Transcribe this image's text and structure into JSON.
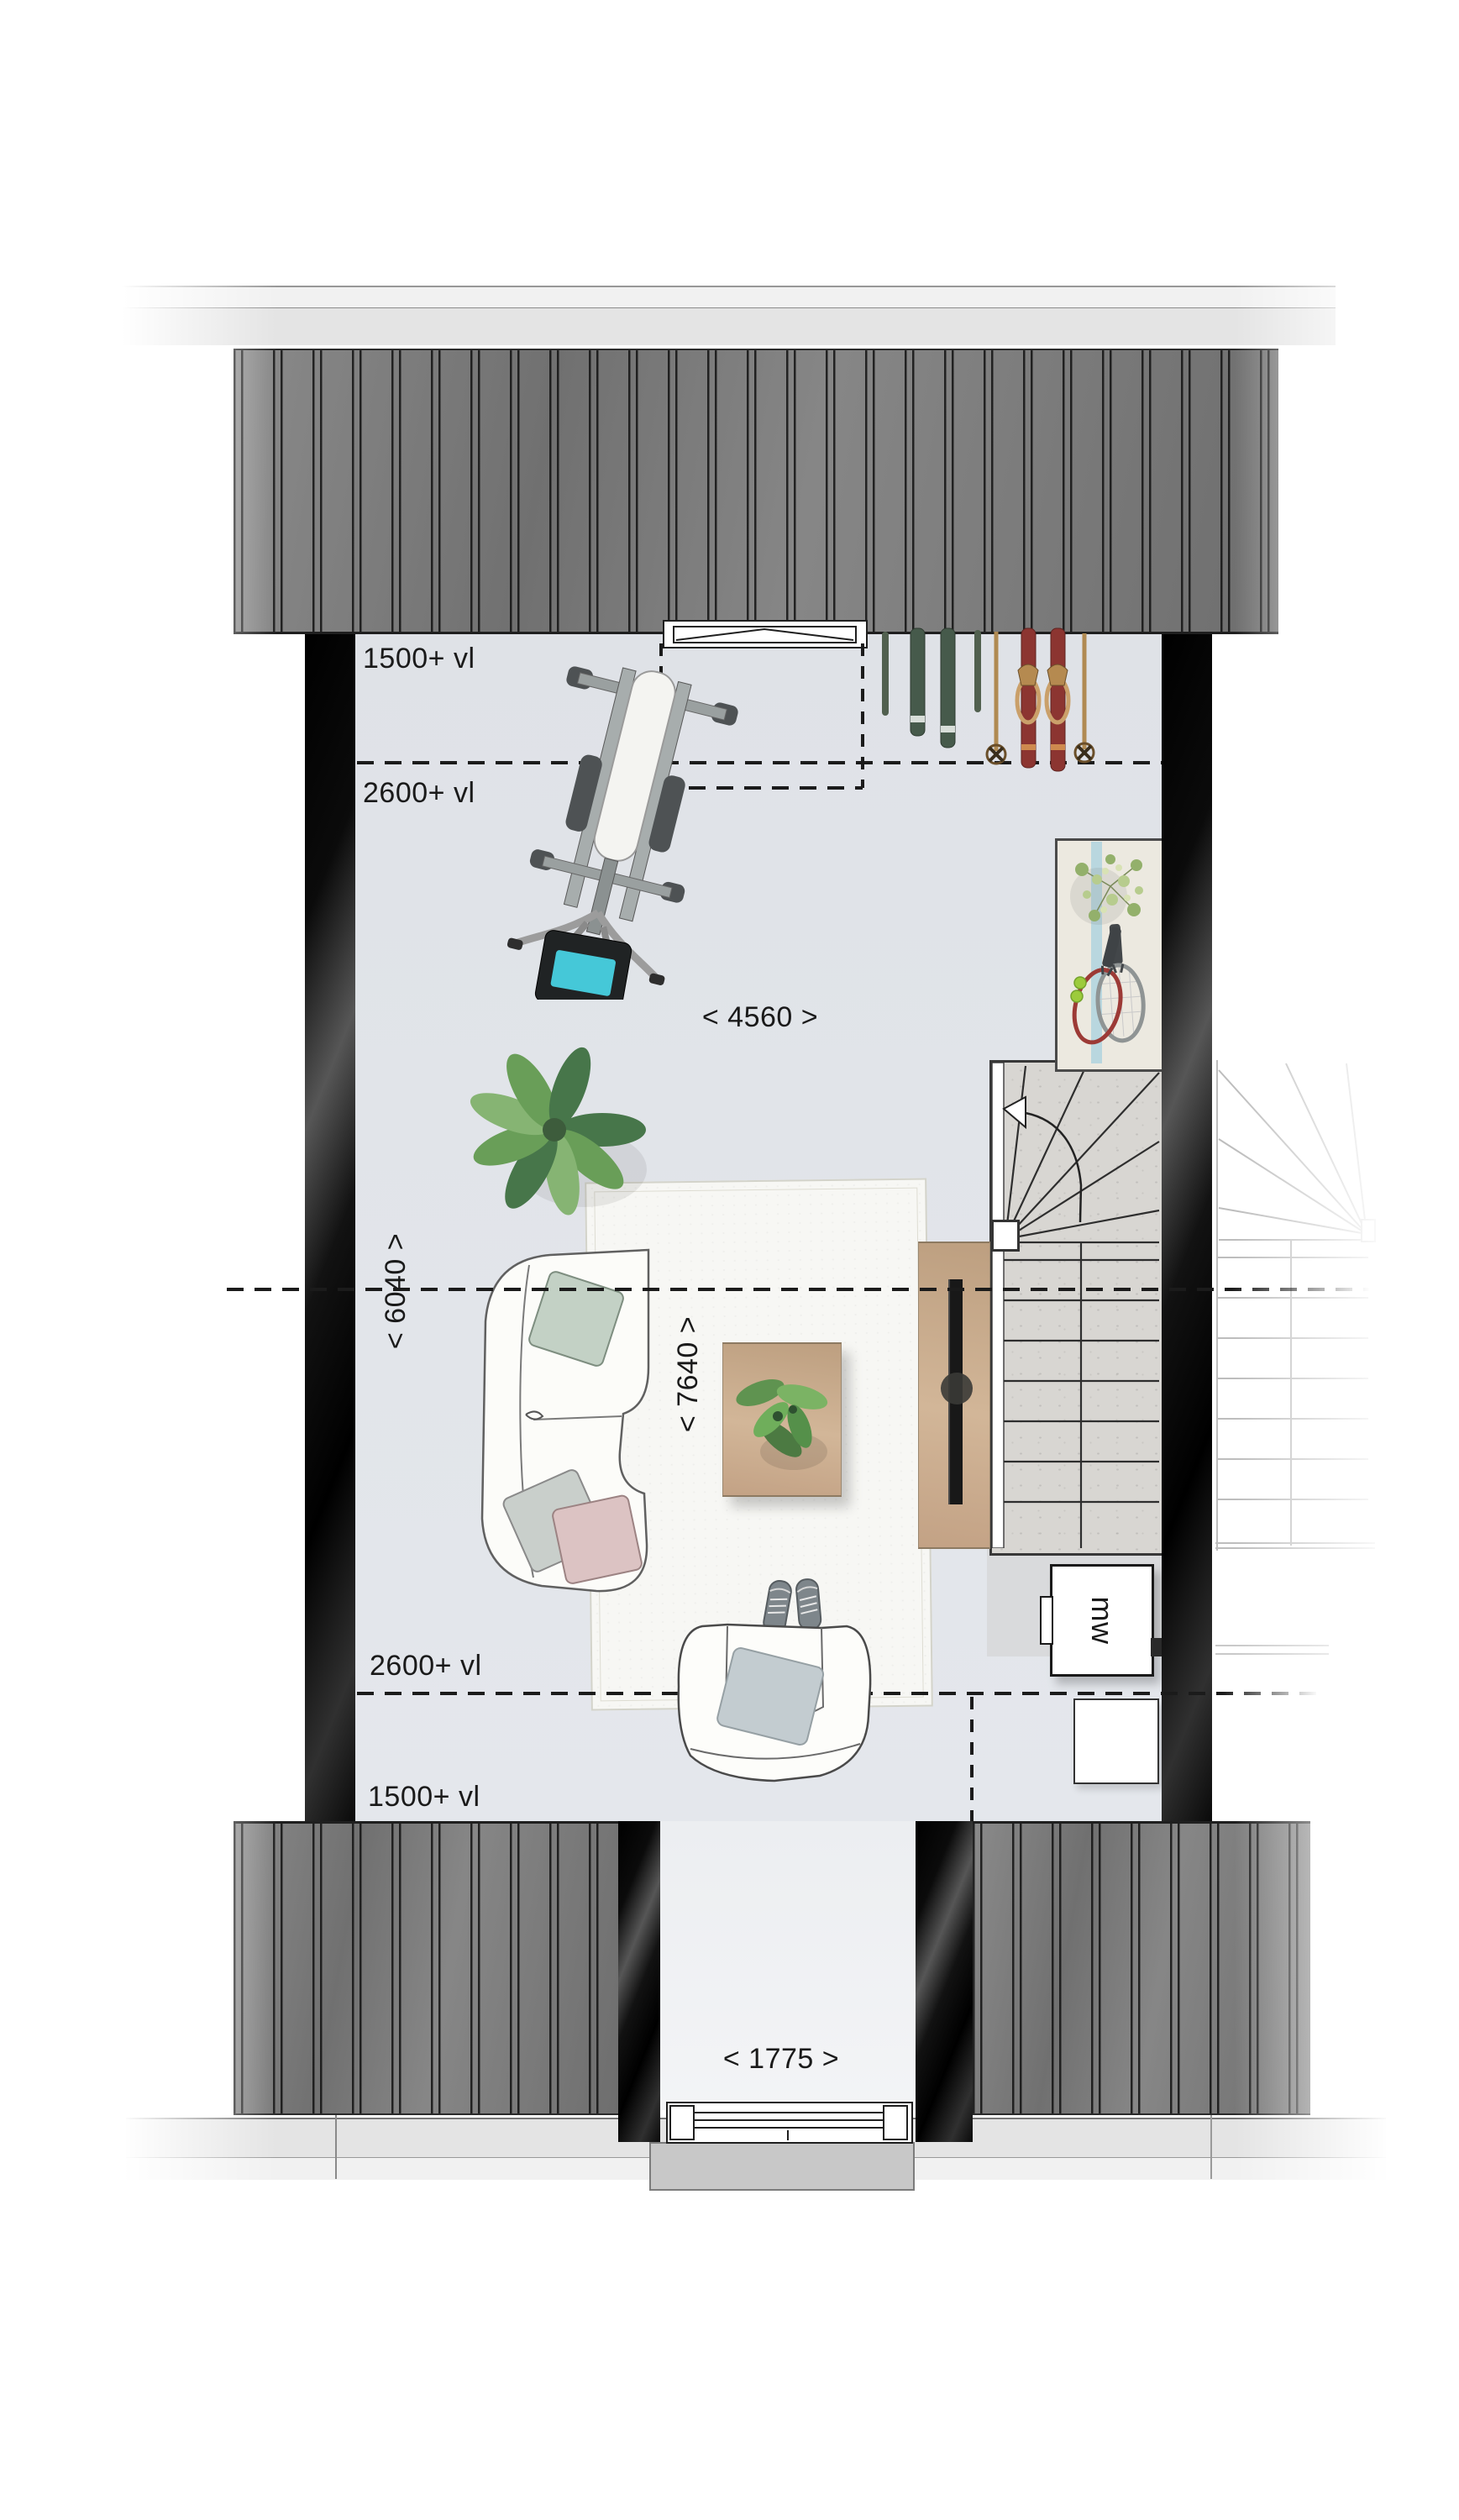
{
  "floorplan": {
    "annotations": {
      "top_zone_upper": "1500+ vl",
      "top_zone_lower": "2600+ vl",
      "bottom_zone_upper": "2600+ vl",
      "bottom_zone_lower": "1500+ vl",
      "room_width": "< 4560 >",
      "room_depth_left": "< 6040 >",
      "room_depth_center": "< 7640 >",
      "entrance_width": "< 1775 >",
      "appliance_label": "mw"
    },
    "colors": {
      "floor": "#e0e3e8",
      "landing": "#d9dadc",
      "wall": "#0a0a0a",
      "roof": "#7d7d7d",
      "roofline": "#1f1f1f",
      "band-light": "#f1f1f1",
      "band-mid": "#e4e4e4",
      "rug": "#f7f7f4",
      "wood": "#c8aa8c",
      "concrete": "#d8d6d2",
      "line": "#1b1b1b",
      "screen": "#45c8d8",
      "ski-green": "#465a4b",
      "ski-red": "#8c3531",
      "pole": "#b08a52",
      "pillow-sage": "#c3d1c5",
      "pillow-pink": "#dcc3c3",
      "pillow-gray": "#c9cfcb",
      "plant": "#699e58",
      "plant-dark": "#47764a",
      "plant-light": "#86b473",
      "chair-pillow": "#c3ccd0",
      "corridor": "#edeff2",
      "slab": "#c8c8c8",
      "shelf": "#ece9e0",
      "shelf-strip": "#b9d7df",
      "text": "#1a1a1a"
    }
  }
}
